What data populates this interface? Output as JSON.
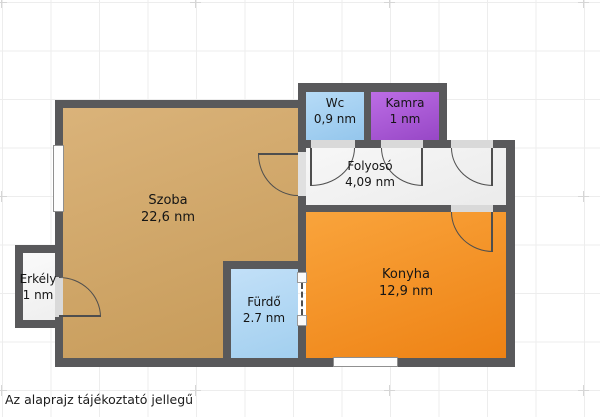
{
  "disclaimer": "Az alaprajz tájékoztató jellegű",
  "rooms": {
    "szoba": {
      "name": "Szoba",
      "area": "22,6 nm",
      "color": "#d0a462"
    },
    "erkely": {
      "name": "Erkély",
      "area": "1 nm",
      "color": "#f5f5f5"
    },
    "wc": {
      "name": "Wc",
      "area": "0,9 nm",
      "color": "#a6d2f2"
    },
    "kamra": {
      "name": "Kamra",
      "area": "1 nm",
      "color": "#ab5cd9"
    },
    "folyoso": {
      "name": "Folyosó",
      "area": "4,09 nm",
      "color": "#f3f3f3"
    },
    "konyha": {
      "name": "Konyha",
      "area": "12,9 nm",
      "color": "#f5941f"
    },
    "furdo": {
      "name": "Fürdő",
      "area": "2.7 nm",
      "color": "#b4d9f5"
    }
  },
  "colors": {
    "wall": "#59595b",
    "door_opening": "#d9d9d9",
    "grid": "#ededed",
    "text": "#151515"
  }
}
